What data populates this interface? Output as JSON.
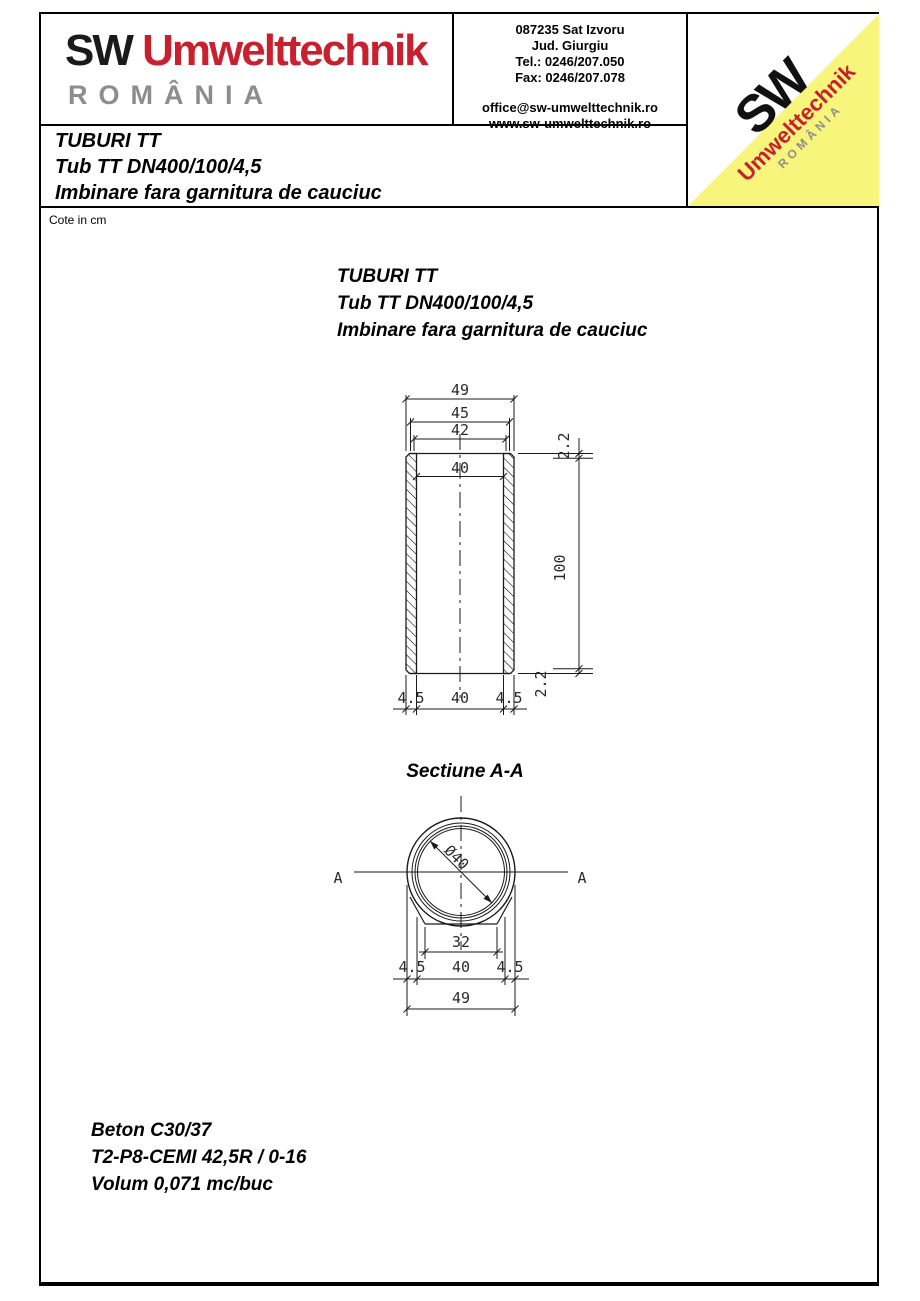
{
  "header": {
    "logo": {
      "sw": "SW",
      "brand": "Umwelttechnik",
      "country": "ROMÂNIA"
    },
    "contact": {
      "line1": "087235 Sat Izvoru",
      "line2": "Jud. Giurgiu",
      "line3": "Tel.: 0246/207.050",
      "line4": "Fax: 0246/207.078",
      "email": "office@sw-umwelttechnik.ro",
      "web": "www.sw-umwelttechnik.ro"
    },
    "corner": {
      "sw": "SW",
      "brand": "Umwelttechnik",
      "country": "ROMÂNIA"
    }
  },
  "title_block": {
    "line1": "TUBURI TT",
    "line2": "Tub TT DN400/100/4,5",
    "line3": "Imbinare fara garnitura de cauciuc"
  },
  "note": "Cote in cm",
  "drawing_title": {
    "line1": "TUBURI TT",
    "line2": "Tub TT DN400/100/4,5",
    "line3": "Imbinare fara garnitura de cauciuc"
  },
  "section_title": "Sectiune A-A",
  "materials": {
    "line1": "Beton C30/37",
    "line2": "T2-P8-CEMI 42,5R / 0-16",
    "line3": "Volum 0,071 mc/buc"
  },
  "dims": {
    "elev": {
      "d49": "49",
      "d45": "45",
      "d42": "42",
      "bore": "40",
      "height": "100",
      "step_top": "2.2",
      "step_bottom": "2.2",
      "wall_l": "4.5",
      "inner": "40",
      "wall_r": "4.5"
    },
    "sect": {
      "marker_l": "A",
      "marker_r": "A",
      "dia": "Ø40",
      "base": "32",
      "wall_l": "4.5",
      "inner": "40",
      "wall_r": "4.5",
      "outer": "49"
    }
  },
  "colors": {
    "brand_red": "#c8202e",
    "brand_gray": "#8d8d8d",
    "corner_yellow": "#f8f57d",
    "line_black": "#000000"
  }
}
